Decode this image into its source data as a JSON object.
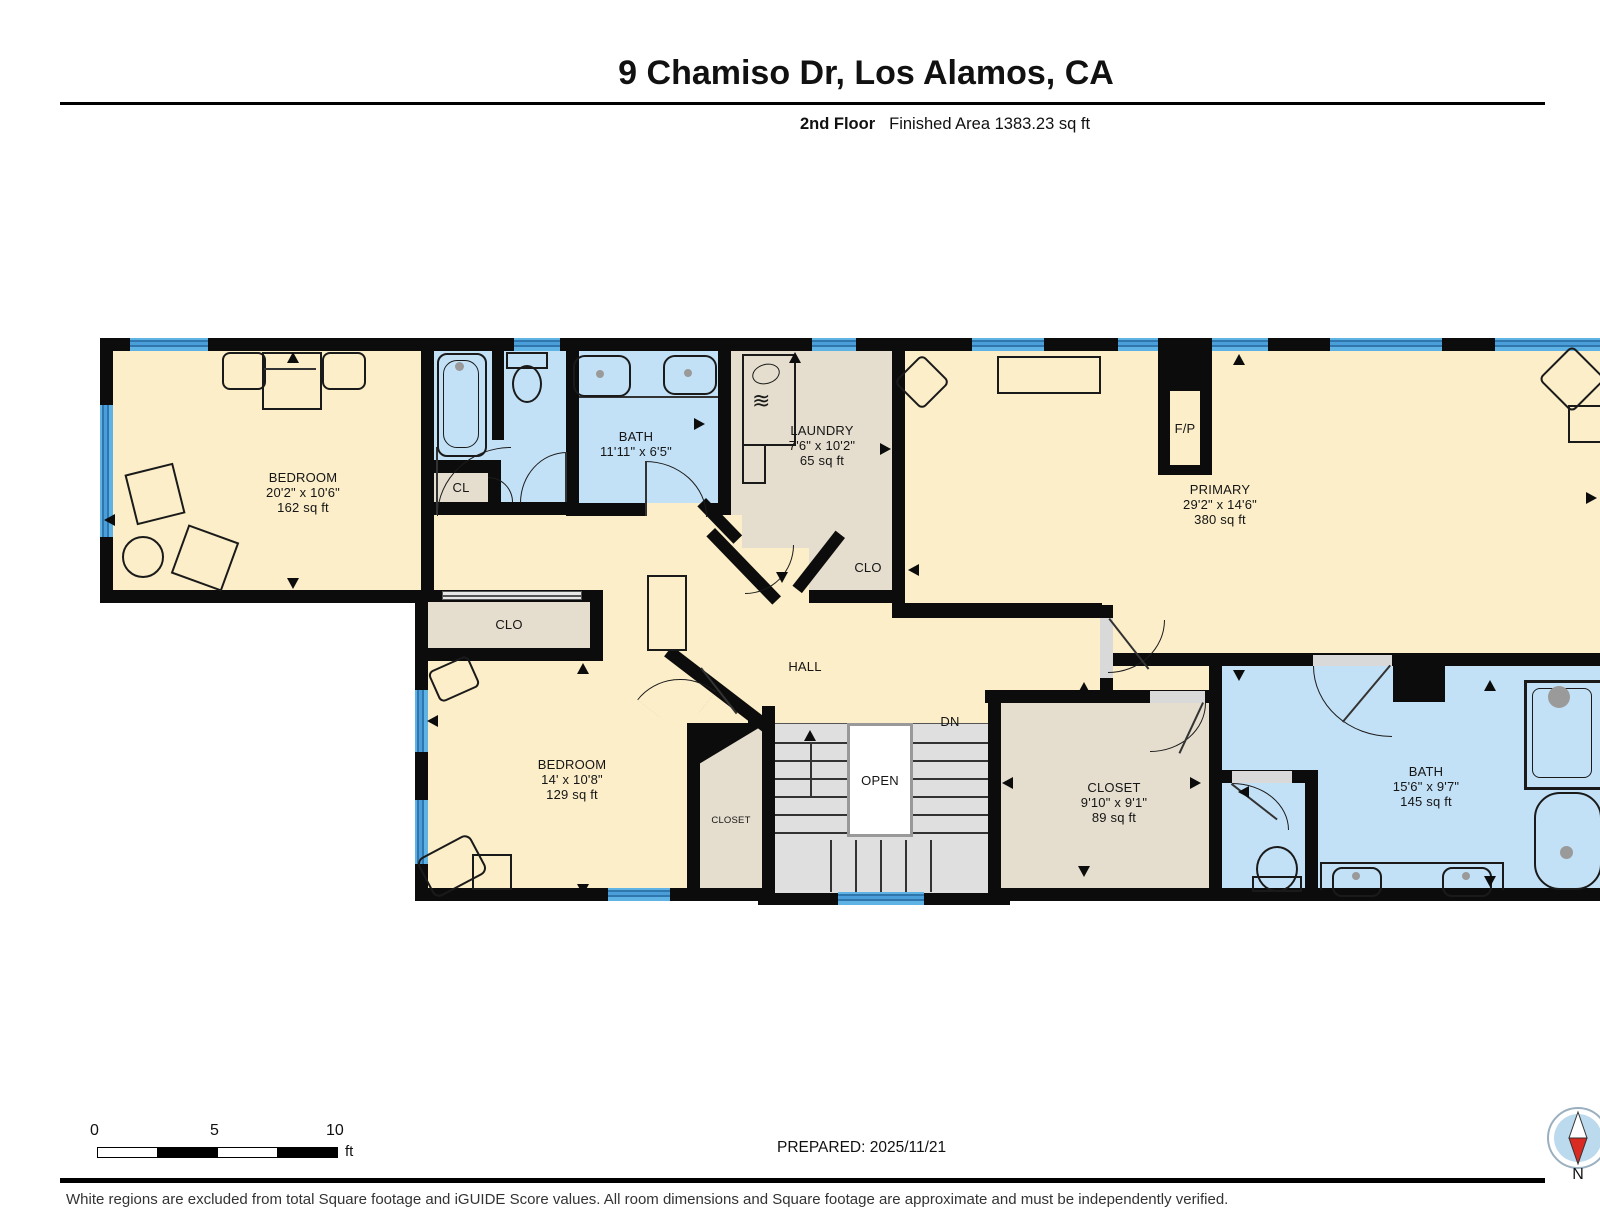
{
  "header": {
    "title": "9 Chamiso Dr, Los Alamos, CA",
    "floor": "2nd Floor",
    "area": "Finished Area 1383.23 sq ft"
  },
  "rooms": {
    "bedroom_tl": {
      "name": "BEDROOM",
      "dims": "20'2\" x 10'6\"",
      "area": "162 sq ft"
    },
    "bath_top": {
      "name": "BATH",
      "dims": "11'11\" x 6'5\""
    },
    "laundry": {
      "name": "LAUNDRY",
      "dims": "7'6\" x 10'2\"",
      "area": "65 sq ft"
    },
    "primary": {
      "name": "PRIMARY",
      "dims": "29'2\" x 14'6\"",
      "area": "380 sq ft"
    },
    "bedroom_bl": {
      "name": "BEDROOM",
      "dims": "14' x 10'8\"",
      "area": "129 sq ft"
    },
    "closet_r": {
      "name": "CLOSET",
      "dims": "9'10\" x 9'1\"",
      "area": "89 sq ft"
    },
    "bath_r": {
      "name": "BATH",
      "dims": "15'6\" x 9'7\"",
      "area": "145 sq ft"
    }
  },
  "labels": {
    "cl": "CL",
    "clo_mid": "CLO",
    "clo_laundry": "CLO",
    "hall": "HALL",
    "open": "OPEN",
    "dn": "DN",
    "closet_small": "CLOSET",
    "fireplace": "F/P"
  },
  "icons": {
    "washer_waves": "≋"
  },
  "footer": {
    "scale": {
      "t0": "0",
      "t1": "5",
      "t2": "10",
      "unit": "ft"
    },
    "prepared": "PREPARED: 2025/11/21",
    "compass": "N",
    "disclaimer": "White regions are excluded from total Square footage and iGUIDE Score values. All room dimensions and Square footage are approximate and must be independently verified."
  },
  "colors": {
    "wall": "#0c0c0c",
    "room_cream": "#FBEEC8",
    "room_blue": "#C3E1F6",
    "room_tan": "#E5DECE",
    "stairs_gray": "#DFDFDF",
    "window_blue": "#4A9ED9",
    "compass_red": "#D92B21"
  }
}
